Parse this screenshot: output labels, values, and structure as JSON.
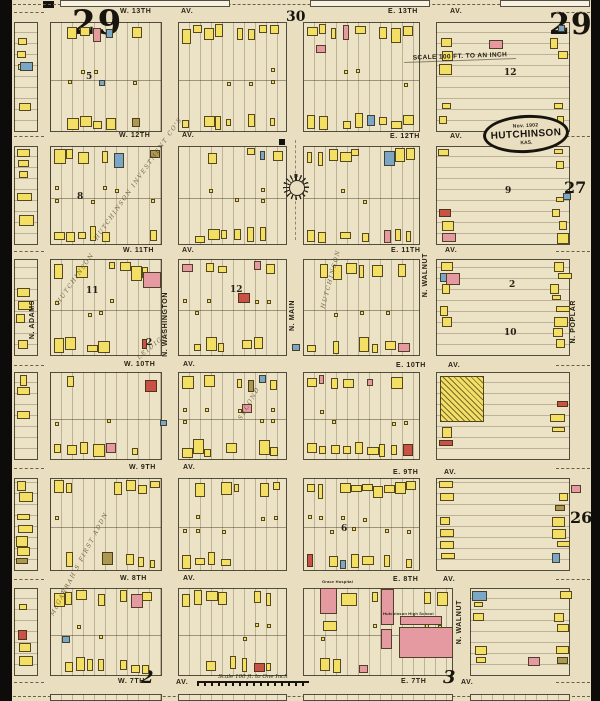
{
  "page": {
    "sheet_left": "29",
    "sheet_right": "29",
    "ref_top": "30",
    "ref_right_upper": "27",
    "ref_right_lower": "26",
    "ref_bottom_left": "2",
    "ref_bottom_right": "3"
  },
  "stamp": {
    "date": "Nov. 1902",
    "city": "HUTCHINSON",
    "state": "KAS."
  },
  "scale_top": "SCALE 100 FT. TO AN INCH",
  "scale_bottom": "Scale 100 ft. to One Inch",
  "street_labels": [
    [
      "W. 13TH",
      120,
      8
    ],
    [
      "AV.",
      181,
      8
    ],
    [
      "E. 13TH",
      388,
      8
    ],
    [
      "AV.",
      450,
      8
    ],
    [
      "W. 12TH",
      119,
      132
    ],
    [
      "AV.",
      182,
      132
    ],
    [
      "E. 12TH",
      390,
      133
    ],
    [
      "AV.",
      450,
      133
    ],
    [
      "W. 11TH",
      123,
      247
    ],
    [
      "AV.",
      182,
      247
    ],
    [
      "E. 11TH",
      391,
      247
    ],
    [
      "AV.",
      445,
      247
    ],
    [
      "W. 10TH",
      124,
      361
    ],
    [
      "AV.",
      183,
      361
    ],
    [
      "E. 10TH",
      396,
      362
    ],
    [
      "AV.",
      448,
      362
    ],
    [
      "W. 9TH",
      129,
      464
    ],
    [
      "AV.",
      183,
      464
    ],
    [
      "E. 9TH",
      393,
      469
    ],
    [
      "AV.",
      444,
      469
    ],
    [
      "W. 8TH",
      120,
      575
    ],
    [
      "AV.",
      183,
      575
    ],
    [
      "E. 8TH",
      393,
      576
    ],
    [
      "AV.",
      443,
      576
    ],
    [
      "W. 7TH",
      118,
      678
    ],
    [
      "AV.",
      176,
      679
    ],
    [
      "E. 7TH",
      401,
      678
    ],
    [
      "AV.",
      461,
      679
    ]
  ],
  "vertical_street_labels": [
    [
      "N. ADAMS",
      29,
      330
    ],
    [
      "N. WASHINGTON",
      162,
      322
    ],
    [
      "N. MAIN",
      289,
      330
    ],
    [
      "N. WALNUT",
      422,
      283
    ],
    [
      "N. WALNUT",
      456,
      630
    ],
    [
      "N. POPLAR",
      570,
      330
    ]
  ],
  "plat_labels": [
    [
      "HUTCHINSON INVESTMENT CO'S",
      96,
      236,
      -55
    ],
    [
      "HUTCHINSON",
      323,
      305,
      -75
    ],
    [
      "HUTCHINSON",
      58,
      300,
      -55
    ],
    [
      "LEIDIGH",
      138,
      355,
      -40
    ],
    [
      "SECOND",
      240,
      416,
      -60
    ],
    [
      "McGARRAH'S FIRST ADDN",
      52,
      612,
      -62
    ]
  ],
  "block_numbers": [
    [
      "5",
      86,
      72
    ],
    [
      "12",
      504,
      68
    ],
    [
      "8",
      77,
      192
    ],
    [
      "9",
      505,
      186
    ],
    [
      "11",
      86,
      286
    ],
    [
      "12",
      230,
      285
    ],
    [
      "2",
      146,
      338
    ],
    [
      "2",
      509,
      280
    ],
    [
      "10",
      504,
      328
    ],
    [
      "6",
      341,
      524
    ]
  ],
  "landmarks": {
    "grace_hospital": {
      "label": "Grace Hospital",
      "x": 322,
      "y": 579,
      "buildings": [
        [
          320,
          588,
          17,
          26,
          "p"
        ],
        [
          341,
          593,
          16,
          13,
          "y"
        ],
        [
          323,
          621,
          14,
          10,
          "y"
        ]
      ]
    },
    "high_school": {
      "label": "Hutchinson High School",
      "x": 383,
      "y": 611,
      "buildings": [
        [
          381,
          589,
          13,
          36,
          "p"
        ],
        [
          381,
          629,
          11,
          20,
          "p"
        ],
        [
          399,
          627,
          54,
          31,
          "p"
        ],
        [
          400,
          616,
          42,
          9,
          "p"
        ]
      ]
    },
    "greenhouse": {
      "x": 440,
      "y": 376,
      "w": 44,
      "h": 46
    }
  },
  "compass": {
    "x": 296,
    "y": 187
  },
  "blocks": [
    [
      14,
      22,
      24,
      110,
      41,
      1
    ],
    [
      50,
      22,
      112,
      110,
      2,
      0
    ],
    [
      178,
      22,
      109,
      110,
      3,
      0
    ],
    [
      303,
      22,
      117,
      110,
      4,
      0
    ],
    [
      436,
      22,
      134,
      110,
      5,
      1
    ],
    [
      14,
      146,
      24,
      99,
      6,
      1
    ],
    [
      50,
      146,
      112,
      99,
      7,
      0
    ],
    [
      178,
      146,
      109,
      99,
      8,
      0
    ],
    [
      303,
      146,
      117,
      99,
      9,
      0
    ],
    [
      436,
      146,
      134,
      99,
      10,
      1
    ],
    [
      14,
      259,
      24,
      97,
      11,
      1
    ],
    [
      50,
      259,
      112,
      97,
      12,
      0
    ],
    [
      178,
      259,
      109,
      97,
      13,
      0
    ],
    [
      303,
      259,
      117,
      97,
      14,
      0
    ],
    [
      436,
      259,
      134,
      97,
      15,
      1
    ],
    [
      14,
      372,
      24,
      88,
      16,
      1
    ],
    [
      50,
      372,
      112,
      88,
      17,
      0
    ],
    [
      178,
      372,
      109,
      88,
      18,
      0
    ],
    [
      303,
      372,
      117,
      88,
      19,
      0
    ],
    [
      436,
      372,
      134,
      88,
      20,
      1
    ],
    [
      14,
      478,
      24,
      93,
      21,
      1
    ],
    [
      50,
      478,
      112,
      93,
      22,
      0
    ],
    [
      178,
      478,
      109,
      93,
      23,
      0
    ],
    [
      303,
      478,
      117,
      93,
      24,
      0
    ],
    [
      436,
      478,
      134,
      93,
      25,
      1
    ],
    [
      14,
      588,
      24,
      88,
      26,
      1
    ],
    [
      50,
      588,
      112,
      88,
      27,
      0
    ],
    [
      178,
      588,
      109,
      88,
      28,
      0
    ],
    [
      303,
      588,
      150,
      88,
      29,
      2
    ],
    [
      470,
      588,
      100,
      88,
      30,
      1
    ],
    [
      50,
      694,
      112,
      7,
      31,
      0
    ],
    [
      178,
      694,
      109,
      7,
      32,
      0
    ],
    [
      303,
      694,
      150,
      7,
      33,
      0
    ],
    [
      470,
      694,
      100,
      7,
      34,
      0
    ],
    [
      60,
      0,
      170,
      7,
      35,
      3
    ],
    [
      310,
      0,
      120,
      7,
      36,
      3
    ],
    [
      500,
      0,
      90,
      7,
      37,
      3
    ]
  ],
  "special_buildings": [
    [
      20,
      62,
      13,
      9,
      "b"
    ],
    [
      99,
      80,
      6,
      6,
      "b"
    ],
    [
      143,
      272,
      18,
      16,
      "p"
    ],
    [
      446,
      273,
      14,
      12,
      "p"
    ],
    [
      489,
      40,
      14,
      9,
      "p"
    ],
    [
      316,
      45,
      10,
      8,
      "p"
    ],
    [
      571,
      485,
      10,
      8,
      "p"
    ],
    [
      563,
      193,
      8,
      7,
      "b"
    ],
    [
      238,
      293,
      12,
      10,
      "r"
    ],
    [
      292,
      344,
      8,
      7,
      "b"
    ],
    [
      160,
      420,
      7,
      6,
      "b"
    ],
    [
      242,
      404,
      10,
      9,
      "p"
    ],
    [
      528,
      657,
      12,
      9,
      "p"
    ],
    [
      62,
      636,
      8,
      7,
      "b"
    ],
    [
      522,
      122,
      9,
      7,
      "b"
    ]
  ],
  "survey_dash_rows": [
    12,
    136,
    251,
    365,
    468,
    579,
    682
  ],
  "palette": {
    "paper": "#e9dfc0",
    "block": "#ece3c6",
    "ink": "#17140d",
    "building_yellow": "#f2df63",
    "building_pink": "#e59aa2",
    "building_red": "#c95247",
    "building_blue": "#7ba7c7",
    "building_olive": "#ad9851"
  }
}
